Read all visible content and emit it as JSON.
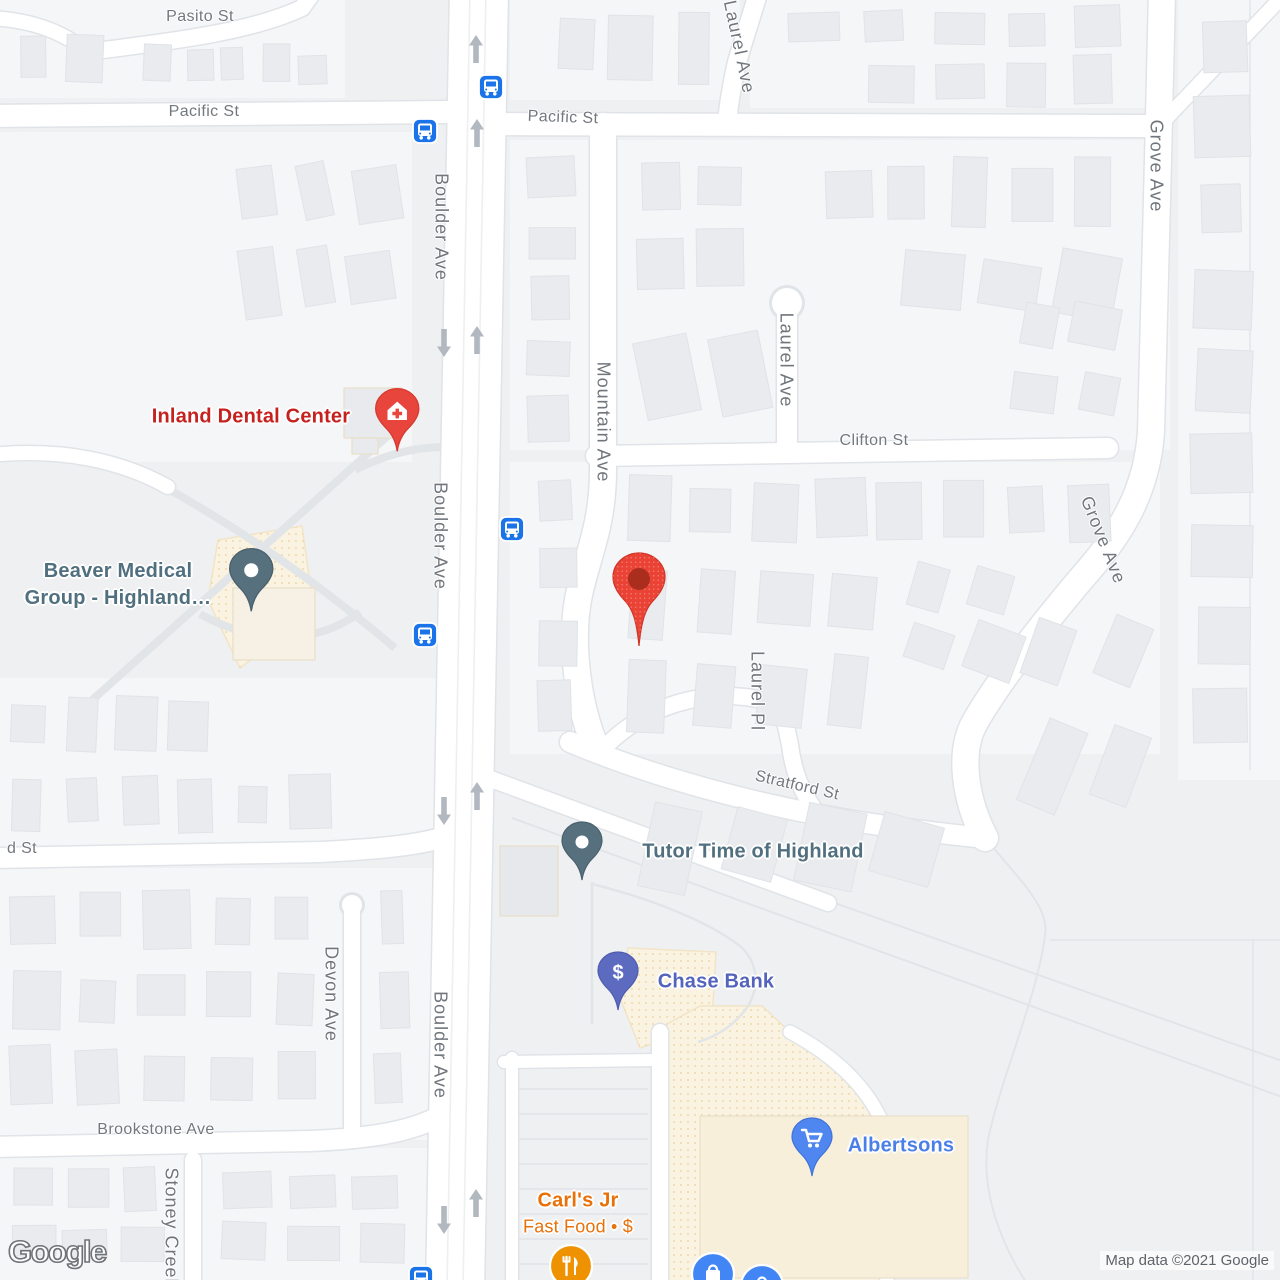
{
  "attribution": {
    "logo_text": "Google",
    "copyright_text": "Map data ©2021 Google"
  },
  "colors": {
    "street_label": "#73787e",
    "bus_blue": "#1a73e8",
    "red_poi_label": "#c5221f",
    "red_pin": "#e8453c",
    "generic_poi_label": "#51707f",
    "generic_poi_pin": "#57707e",
    "bank_poi_label": "#5463bb",
    "bank_poi_pin": "#5c6ac0",
    "shopping_poi_label": "#4b7fe8",
    "shopping_poi_pin": "#4f86ef",
    "food_poi_label": "#e8710a",
    "food_poi_badge": "#ef9202",
    "destination_pin": "#ea4335"
  },
  "streets": [
    {
      "name": "Pasito St",
      "x": 200,
      "y": 17,
      "rot": 0,
      "big": false
    },
    {
      "name": "Pacific St",
      "x": 204,
      "y": 112,
      "rot": 0,
      "big": false
    },
    {
      "name": "Pacific St",
      "x": 563,
      "y": 118,
      "rot": 2,
      "big": false
    },
    {
      "name": "Boulder Ave",
      "x": 441,
      "y": 227,
      "rot": 90,
      "big": true
    },
    {
      "name": "Boulder Ave",
      "x": 440,
      "y": 536,
      "rot": 90,
      "big": true
    },
    {
      "name": "Boulder Ave",
      "x": 440,
      "y": 1045,
      "rot": 90,
      "big": true
    },
    {
      "name": "Mountain Ave",
      "x": 603,
      "y": 422,
      "rot": 90,
      "big": true
    },
    {
      "name": "Laurel Ave",
      "x": 739,
      "y": 47,
      "rot": 78,
      "big": true
    },
    {
      "name": "Laurel Ave",
      "x": 786,
      "y": 360,
      "rot": 90,
      "big": true
    },
    {
      "name": "Grove Ave",
      "x": 1156,
      "y": 166,
      "rot": 90,
      "big": true
    },
    {
      "name": "Grove Ave",
      "x": 1103,
      "y": 540,
      "rot": 68,
      "big": true
    },
    {
      "name": "Clifton St",
      "x": 874,
      "y": 441,
      "rot": 0,
      "big": false
    },
    {
      "name": "Laurel Pl",
      "x": 757,
      "y": 691,
      "rot": 90,
      "big": true
    },
    {
      "name": "Stratford St",
      "x": 797,
      "y": 786,
      "rot": 13,
      "big": false
    },
    {
      "name": "d St",
      "x": 22,
      "y": 849,
      "rot": 0,
      "big": false
    },
    {
      "name": "Devon Ave",
      "x": 331,
      "y": 994,
      "rot": 90,
      "big": true
    },
    {
      "name": "Brookstone Ave",
      "x": 156,
      "y": 1130,
      "rot": 0,
      "big": false
    },
    {
      "name": "Stoney Creek",
      "x": 171,
      "y": 1228,
      "rot": 90,
      "big": true
    }
  ],
  "pois": [
    {
      "id": "inland-dental",
      "lines": [
        "Inland Dental Center"
      ],
      "label_color": "#c5221f",
      "label_x": 251,
      "label_y": 417,
      "pin": {
        "x": 397,
        "y": 410,
        "color": "#e8453c",
        "stroke": "#d63a2f",
        "icon": "house-cross"
      }
    },
    {
      "id": "beaver-medical",
      "lines": [
        "Beaver Medical",
        "Group - Highland…"
      ],
      "label_color": "#51707f",
      "label_x": 118,
      "label_y": 585,
      "pin": {
        "x": 251,
        "y": 570,
        "color": "#57707e",
        "stroke": "#49606d",
        "icon": "dot"
      }
    },
    {
      "id": "tutor-time",
      "lines": [
        "Tutor Time of Highland"
      ],
      "label_color": "#51707f",
      "label_x": 753,
      "label_y": 852,
      "pin": {
        "x": 582,
        "y": 842,
        "color": "#57707e",
        "stroke": "#49606d",
        "icon": "dot"
      }
    },
    {
      "id": "chase-bank",
      "lines": [
        "Chase Bank"
      ],
      "label_color": "#5463bb",
      "label_x": 716,
      "label_y": 982,
      "pin": {
        "x": 618,
        "y": 972,
        "color": "#5c6ac0",
        "stroke": "#4f5cae",
        "icon": "dollar"
      }
    },
    {
      "id": "albertsons",
      "lines": [
        "Albertsons"
      ],
      "label_color": "#4b7fe8",
      "label_x": 901,
      "label_y": 1146,
      "pin": {
        "x": 812,
        "y": 1138,
        "color": "#4f86ef",
        "stroke": "#3f74d8",
        "icon": "cart"
      }
    },
    {
      "id": "carls-jr",
      "lines": [
        "Carl's Jr"
      ],
      "sub": "Fast Food • $",
      "label_color": "#e8710a",
      "label_x": 578,
      "label_y": 1213,
      "pin": {
        "x": 571,
        "y": 1266,
        "color": "#ef9202",
        "stroke": "#ffffff",
        "icon": "fork-knife",
        "shape": "circle"
      }
    }
  ],
  "badges": [
    {
      "id": "store-badge-1",
      "icon": "bag",
      "x": 713,
      "y": 1274,
      "color": "#4285f4"
    },
    {
      "id": "store-badge-2",
      "icon": "bag",
      "x": 762,
      "y": 1286,
      "color": "#4285f4"
    }
  ],
  "transit_stops": [
    {
      "x": 491,
      "y": 87
    },
    {
      "x": 425,
      "y": 131
    },
    {
      "x": 512,
      "y": 529
    },
    {
      "x": 425,
      "y": 635
    },
    {
      "x": 421,
      "y": 1278
    }
  ],
  "one_way_arrows": {
    "up": [
      {
        "x": 476,
        "y": 49
      },
      {
        "x": 477,
        "y": 133
      },
      {
        "x": 477,
        "y": 340
      },
      {
        "x": 477,
        "y": 796
      },
      {
        "x": 476,
        "y": 1203
      }
    ],
    "down": [
      {
        "x": 444,
        "y": 343
      },
      {
        "x": 444,
        "y": 811
      },
      {
        "x": 444,
        "y": 1220
      }
    ]
  },
  "destination_pin": {
    "x": 639,
    "y": 579,
    "color": "#ea4335",
    "inner": "#aa2d1d"
  }
}
